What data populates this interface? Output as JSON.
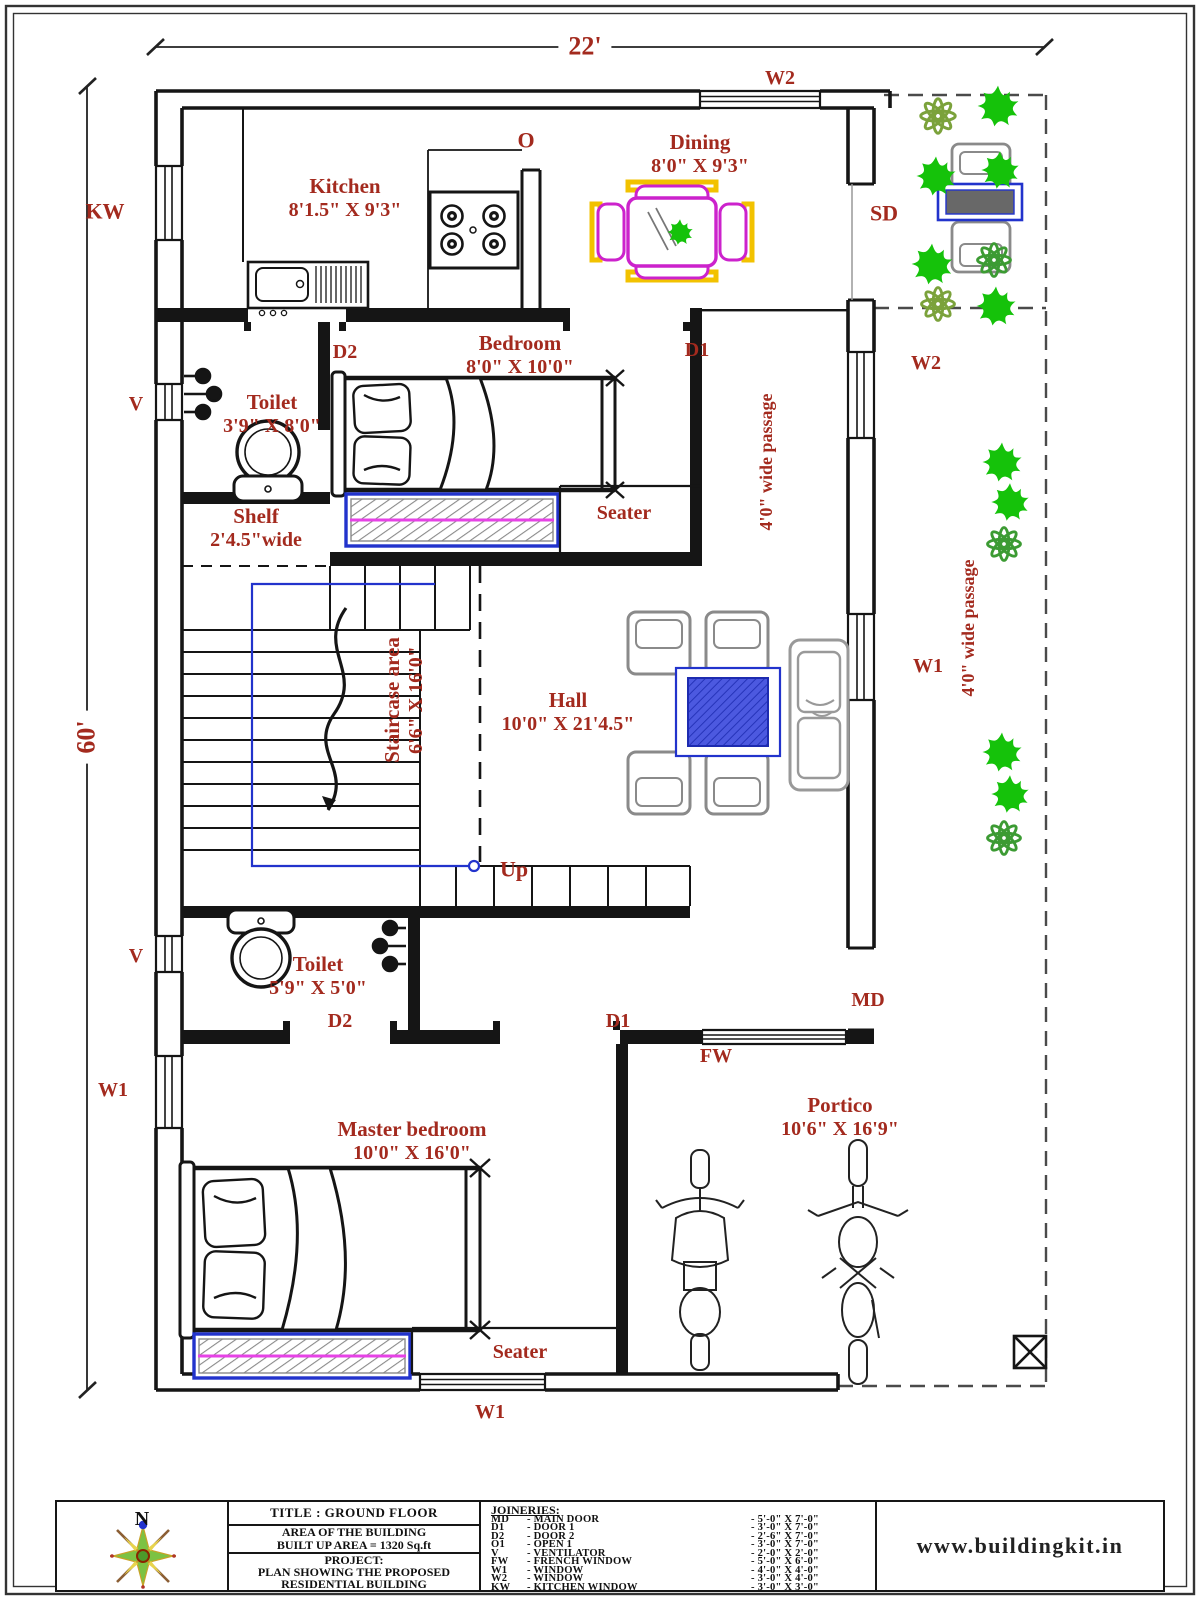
{
  "dimensions": {
    "width": "22'",
    "height": "60'"
  },
  "rooms": {
    "kitchen": {
      "name": "Kitchen",
      "size": "8'1.5\" X 9'3\""
    },
    "dining": {
      "name": "Dining",
      "size": "8'0\" X 9'3\""
    },
    "bedroom": {
      "name": "Bedroom",
      "size": "8'0\" X 10'0\""
    },
    "toilet1": {
      "name": "Toilet",
      "size": "3'9\" X 8'0\""
    },
    "shelf": {
      "name": "Shelf",
      "size": "2'4.5\"wide"
    },
    "staircase": {
      "name": "Staircase area",
      "size": "6'6\" X 16'0\""
    },
    "hall": {
      "name": "Hall",
      "size": "10'0\" X 21'4.5\""
    },
    "toilet2": {
      "name": "Toilet",
      "size": "5'9\" X 5'0\""
    },
    "master_bedroom": {
      "name": "Master bedroom",
      "size": "10'0\" X 16'0\""
    },
    "portico": {
      "name": "Portico",
      "size": "10'6\" X 16'9\""
    },
    "seater_1": "Seater",
    "seater_2": "Seater",
    "passage_1": "4'0\" wide passage",
    "passage_2": "4'0\" wide passage",
    "up": "Up"
  },
  "markers": {
    "kw": "KW",
    "o": "O",
    "w2_top": "W2",
    "sd": "SD",
    "w2_right": "W2",
    "d2_bedroom": "D2",
    "d1_bedroom": "D1",
    "v_toilet1": "V",
    "w1_right": "W1",
    "v_toilet2": "V",
    "md": "MD",
    "d2_toilet2": "D2",
    "d1_master": "D1",
    "fw": "FW",
    "w1_left": "W1",
    "w1_bottom": "W1"
  },
  "compass": {
    "north": "N"
  },
  "title_block": {
    "title": "TITLE : GROUND FLOOR",
    "area_line1": "AREA OF THE BUILDING",
    "area_line2": "BUILT UP AREA  = 1320 Sq.ft",
    "project_label": "PROJECT:",
    "project_line1": "PLAN SHOWING THE PROPOSED",
    "project_line2": "RESIDENTIAL BUILDING",
    "joineries": {
      "heading": "JOINERIES:",
      "rows": [
        {
          "code": "MD",
          "name": "- MAIN DOOR",
          "size": "- 5'-0\" X 7'-0\""
        },
        {
          "code": "D1",
          "name": "- DOOR 1",
          "size": "- 3'-0\" X 7'-0\""
        },
        {
          "code": "D2",
          "name": "- DOOR 2",
          "size": "- 2'-6\" X 7'-0\""
        },
        {
          "code": "O1",
          "name": "- OPEN 1",
          "size": "- 3'-0\" X 7'-0\""
        },
        {
          "code": "V",
          "name": "- VENTILATOR",
          "size": "- 2'-0\" X 2'-0\""
        },
        {
          "code": "FW",
          "name": "- FRENCH WINDOW",
          "size": "- 5'-0\" X 6'-0\""
        },
        {
          "code": "W1",
          "name": "- WINDOW",
          "size": "- 4'-0\" X 4'-0\""
        },
        {
          "code": "W2",
          "name": "- WINDOW",
          "size": "- 3'-0\" X 4'-0\""
        },
        {
          "code": "KW",
          "name": "- KITCHEN WINDOW",
          "size": "- 3'-0\" X 3'-0\""
        }
      ]
    },
    "website": "www.buildingkit.in"
  },
  "colors": {
    "label_red": "#A32A1E",
    "wall": "#151515",
    "accent_blue": "#2233CC",
    "magenta": "#CC22CC",
    "yellow": "#F2C200",
    "plant_green": "#15C20A",
    "plant_olive": "#7BA23B",
    "furniture_gray": "#8A8A8A"
  }
}
